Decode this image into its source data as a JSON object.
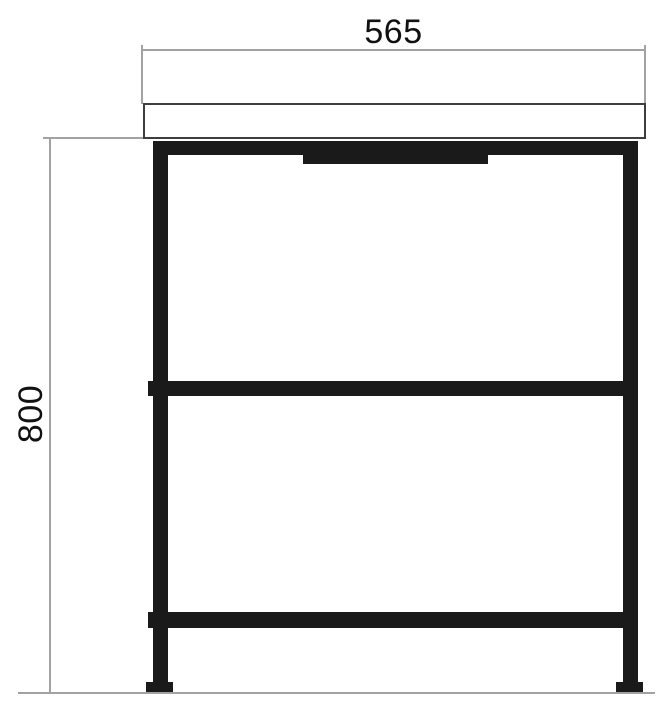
{
  "drawing": {
    "type": "furniture-dimension-drawing",
    "width_dimension": {
      "value": "565"
    },
    "height_dimension": {
      "value": "800"
    }
  },
  "colors": {
    "frame": "#1a1a1a",
    "construction_line": "#a2a2a2",
    "countertop_border": "#3e3e3e",
    "text": "#111111",
    "background": "#ffffff"
  }
}
